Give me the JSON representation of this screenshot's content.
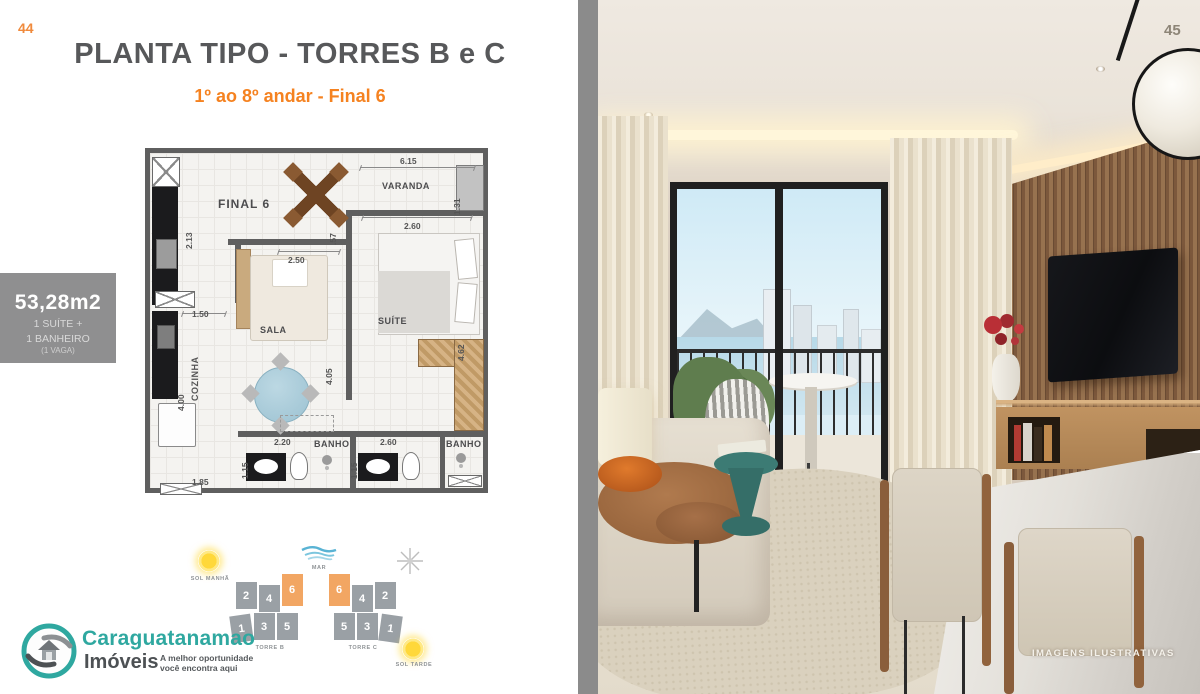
{
  "page": {
    "left_page_number": "44",
    "right_page_number": "45",
    "title": "PLANTA TIPO - TORRES B e C",
    "subtitle": "1º ao 8º andar - Final 6"
  },
  "area_badge": {
    "area": "53,28m2",
    "line1": "1 SUÍTE +",
    "line2": "1 BANHEIRO",
    "line3": "(1 VAGA)"
  },
  "floor_plan": {
    "unit_label": "FINAL 6",
    "rooms": {
      "varanda": "VARANDA",
      "sala": "SALA",
      "suite": "SUÍTE",
      "cozinha": "COZINHA",
      "banho1": "BANHO",
      "banho2": "BANHO"
    },
    "dims": {
      "d615": "6.15",
      "d131": "1.31",
      "d213": "2.13",
      "d057": ".57",
      "d250": "2.50",
      "d260a": "2.60",
      "d150": "1.50",
      "d405": "4.05",
      "d400": "4.00",
      "d462": "4.62",
      "d220": "2.20",
      "d115a": "1.15",
      "d260b": "2.60",
      "d115b": "1.15",
      "d185": "1.85"
    }
  },
  "site_diagram": {
    "sun_morning_label": "SOL MANHÃ",
    "sea_label": "MAR",
    "sun_afternoon_label": "SOL TARDE",
    "towers": [
      {
        "name": "TORRE B",
        "top_units": [
          "2",
          "4",
          "6"
        ],
        "bottom_units": [
          "1",
          "3",
          "5"
        ],
        "highlighted_unit": "6"
      },
      {
        "name": "TORRE C",
        "top_units": [
          "6",
          "4",
          "2"
        ],
        "bottom_units": [
          "5",
          "3",
          "1"
        ],
        "highlighted_unit": "6"
      }
    ]
  },
  "logo": {
    "name": "Caraguatanamao",
    "type": "Imóveis",
    "tagline1": "A melhor oportunidade",
    "tagline2": "você encontra aqui"
  },
  "photo": {
    "caption": "IMAGENS ILUSTRATIVAS"
  },
  "colors": {
    "accent_orange": "#f58220",
    "title_gray": "#57585a",
    "badge_gray": "#8f8f90",
    "unit_gray": "#9aa0a5",
    "unit_highlight_orange": "#f2a663",
    "logo_teal": "#2fa8a0"
  }
}
